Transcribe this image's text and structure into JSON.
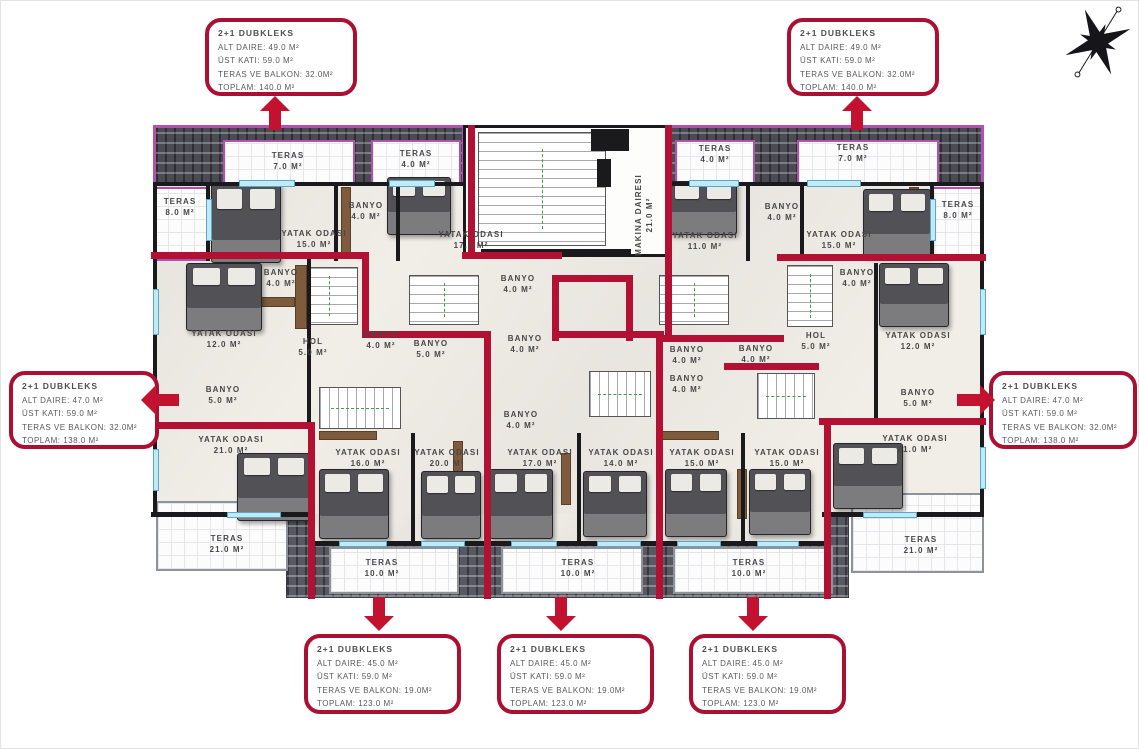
{
  "colors": {
    "unit_wall_red": "#b31133",
    "callout_border": "#ab0f31",
    "roof_purple": "#b153ae",
    "tile_gray": "#4b4b54",
    "window_blue": "#c2e9f6",
    "label_gray": "#474747"
  },
  "compass": {
    "icon": "compass-rose-icon"
  },
  "callouts": [
    {
      "id": "top-left",
      "box": [
        204,
        17,
        152,
        78
      ],
      "title": "2+1 DUBKLEKS",
      "lines": [
        "ALT DAIRE: 49.0 M²",
        "ÜST KATI: 59.0 M²",
        "TERAS VE BALKON: 32.0M²",
        "TOPLAM: 140.0 M²"
      ],
      "arrow": {
        "dir": "up",
        "x": 259,
        "y": 95
      }
    },
    {
      "id": "top-right",
      "box": [
        786,
        17,
        152,
        78
      ],
      "title": "2+1 DUBKLEKS",
      "lines": [
        "ALT DAIRE: 49.0 M²",
        "ÜST KATI: 59.0 M²",
        "TERAS VE BALKON: 32.0M²",
        "TOPLAM: 140.0 M²"
      ],
      "arrow": {
        "dir": "up",
        "x": 841,
        "y": 95
      }
    },
    {
      "id": "left",
      "box": [
        8,
        370,
        150,
        78
      ],
      "title": "2+1 DUBKLEKS",
      "lines": [
        "ALT DAIRE: 47.0 M²",
        "ÜST KATI: 59.0 M²",
        "TERAS VE BALKON: 32.0M²",
        "TOPLAM: 138.0 M²"
      ],
      "arrow": {
        "dir": "left",
        "x": 140,
        "y": 384
      }
    },
    {
      "id": "right",
      "box": [
        988,
        370,
        148,
        78
      ],
      "title": "2+1 DUBKLEKS",
      "lines": [
        "ALT DAIRE: 47.0 M²",
        "ÜST KATI: 59.0 M²",
        "TERAS VE BALKON: 32.0M²",
        "TOPLAM: 138.0 M²"
      ],
      "arrow": {
        "dir": "right",
        "x": 956,
        "y": 384
      }
    },
    {
      "id": "bottom-left",
      "box": [
        303,
        633,
        157,
        80
      ],
      "title": "2+1 DUBKLEKS",
      "lines": [
        "ALT DAIRE: 45.0 M²",
        "ÜST KATI: 59.0 M²",
        "TERAS VE BALKON: 19.0M²",
        "TOPLAM: 123.0 M²"
      ],
      "arrow": {
        "dir": "down",
        "x": 363,
        "y": 596
      }
    },
    {
      "id": "bottom-center",
      "box": [
        496,
        633,
        157,
        80
      ],
      "title": "2+1 DUBKLEKS",
      "lines": [
        "ALT DAIRE: 45.0 M²",
        "ÜST KATI: 59.0 M²",
        "TERAS VE BALKON: 19.0M²",
        "TOPLAM: 123.0 M²"
      ],
      "arrow": {
        "dir": "down",
        "x": 545,
        "y": 596
      }
    },
    {
      "id": "bottom-right",
      "box": [
        688,
        633,
        157,
        80
      ],
      "title": "2+1 DUBKLEKS",
      "lines": [
        "ALT DAIRE: 45.0 M²",
        "ÜST KATI: 59.0 M²",
        "TERAS VE BALKON: 19.0M²",
        "TOPLAM: 123.0 M²"
      ],
      "arrow": {
        "dir": "down",
        "x": 737,
        "y": 596
      }
    }
  ],
  "rooms": [
    {
      "name": "TERAS",
      "area": "7.0 M²",
      "x": 287,
      "y": 160
    },
    {
      "name": "TERAS",
      "area": "4.0 M²",
      "x": 415,
      "y": 158
    },
    {
      "name": "TERAS",
      "area": "8.0 M²",
      "x": 179,
      "y": 206
    },
    {
      "name": "YATAK ODASI",
      "area": "15.0 M²",
      "x": 313,
      "y": 238
    },
    {
      "name": "BANYO",
      "area": "4.0 M²",
      "x": 365,
      "y": 210
    },
    {
      "name": "YATAK ODASI",
      "area": "17.0 M²",
      "x": 470,
      "y": 239
    },
    {
      "name": "MAKINA DAIRESI",
      "area": "21.0 M²",
      "x": 643,
      "y": 214,
      "rot": true
    },
    {
      "name": "TERAS",
      "area": "4.0 M²",
      "x": 714,
      "y": 153
    },
    {
      "name": "YATAK ODASI",
      "area": "11.0 M²",
      "x": 704,
      "y": 240
    },
    {
      "name": "BANYO",
      "area": "4.0 M²",
      "x": 781,
      "y": 211
    },
    {
      "name": "TERAS",
      "area": "7.0 M²",
      "x": 852,
      "y": 152
    },
    {
      "name": "YATAK ODASI",
      "area": "15.0 M²",
      "x": 838,
      "y": 239
    },
    {
      "name": "TERAS",
      "area": "8.0 M²",
      "x": 957,
      "y": 209
    },
    {
      "name": "BANYO",
      "area": "4.0 M²",
      "x": 280,
      "y": 277
    },
    {
      "name": "YATAK ODASI",
      "area": "12.0 M²",
      "x": 223,
      "y": 338
    },
    {
      "name": "HOL",
      "area": "5.0 M²",
      "x": 312,
      "y": 346
    },
    {
      "name": "BANYO",
      "area": "5.0 M²",
      "x": 222,
      "y": 394
    },
    {
      "name": "BANYO",
      "area": "4.0 M²",
      "x": 380,
      "y": 339
    },
    {
      "name": "BANYO",
      "area": "5.0 M²",
      "x": 430,
      "y": 348
    },
    {
      "name": "BANYO",
      "area": "4.0 M²",
      "x": 517,
      "y": 283
    },
    {
      "name": "BANYO",
      "area": "4.0 M²",
      "x": 524,
      "y": 343
    },
    {
      "name": "BANYO",
      "area": "4.0 M²",
      "x": 520,
      "y": 419
    },
    {
      "name": "BANYO",
      "area": "4.0 M²",
      "x": 686,
      "y": 354
    },
    {
      "name": "BANYO",
      "area": "4.0 M²",
      "x": 686,
      "y": 383
    },
    {
      "name": "BANYO",
      "area": "4.0 M²",
      "x": 755,
      "y": 353
    },
    {
      "name": "HOL",
      "area": "5.0 M²",
      "x": 815,
      "y": 340
    },
    {
      "name": "BANYO",
      "area": "4.0 M²",
      "x": 856,
      "y": 277
    },
    {
      "name": "YATAK ODASI",
      "area": "12.0 M²",
      "x": 917,
      "y": 340
    },
    {
      "name": "BANYO",
      "area": "5.0 M²",
      "x": 917,
      "y": 397
    },
    {
      "name": "YATAK ODASI",
      "area": "21.0 M²",
      "x": 230,
      "y": 444
    },
    {
      "name": "TERAS",
      "area": "21.0 M²",
      "x": 226,
      "y": 543
    },
    {
      "name": "YATAK ODASI",
      "area": "16.0 M²",
      "x": 367,
      "y": 457
    },
    {
      "name": "YATAK ODASI",
      "area": "20.0 M²",
      "x": 446,
      "y": 457
    },
    {
      "name": "TERAS",
      "area": "10.0 M²",
      "x": 381,
      "y": 567
    },
    {
      "name": "YATAK ODASI",
      "area": "17.0 M²",
      "x": 539,
      "y": 457
    },
    {
      "name": "YATAK ODASI",
      "area": "14.0 M²",
      "x": 620,
      "y": 457
    },
    {
      "name": "TERAS",
      "area": "10.0 M²",
      "x": 577,
      "y": 567
    },
    {
      "name": "YATAK ODASI",
      "area": "15.0 M²",
      "x": 701,
      "y": 457
    },
    {
      "name": "YATAK ODASI",
      "area": "15.0 M²",
      "x": 786,
      "y": 457
    },
    {
      "name": "TERAS",
      "area": "10.0 M²",
      "x": 748,
      "y": 567
    },
    {
      "name": "YATAK ODASI",
      "area": "21.0 M²",
      "x": 914,
      "y": 443
    },
    {
      "name": "TERAS",
      "area": "21.0 M²",
      "x": 920,
      "y": 544
    }
  ]
}
